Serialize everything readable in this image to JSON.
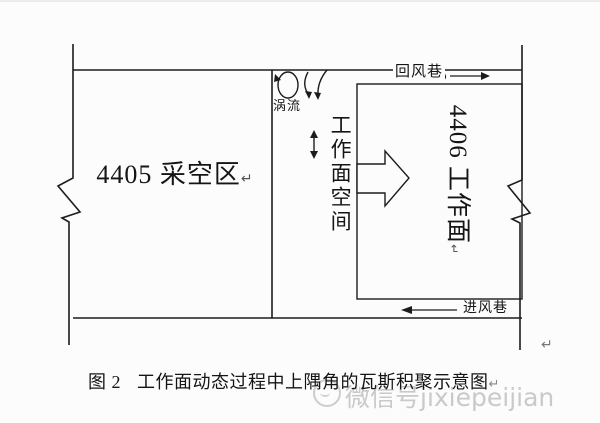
{
  "diagram": {
    "goaf_label": "4405 采空区",
    "vortex_label": "涡流",
    "face_space_label": "工作面空间",
    "working_face_label": "4406 工作面",
    "return_airway_label": "回风巷",
    "intake_airway_label": "进风巷",
    "paragraph_mark": "↵"
  },
  "caption": {
    "prefix": "图 2",
    "title": "工作面动态过程中上隅角的瓦斯积聚示意图",
    "paragraph_mark": "↵"
  },
  "watermark": {
    "logo": "wechat-logo",
    "text": "微信号jixiepeijian"
  },
  "colors": {
    "line": "#1c1c1c",
    "text": "#151515",
    "watermark": "#c9c9c9",
    "background": "#fcfcfc"
  }
}
